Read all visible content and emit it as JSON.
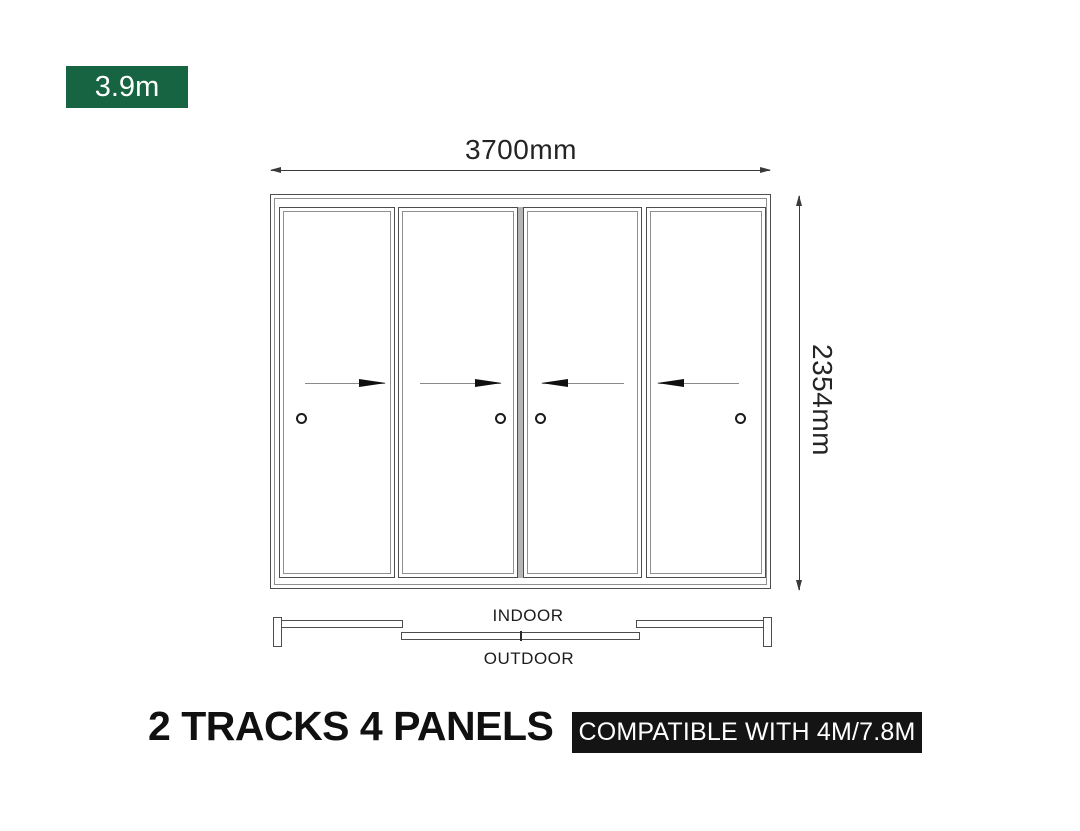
{
  "size_badge": {
    "label": "3.9m",
    "bg_color": "#166442",
    "text_color": "#ffffff"
  },
  "dimensions": {
    "width": {
      "label": "3700mm"
    },
    "height": {
      "label": "2354mm"
    }
  },
  "door_diagram": {
    "type": "sliding-door-elevation",
    "panel_count": 4,
    "track_count": 2,
    "panels": [
      {
        "id": 1,
        "slide_direction": "right",
        "handle_position": "left"
      },
      {
        "id": 2,
        "slide_direction": "right",
        "handle_position": "right"
      },
      {
        "id": 3,
        "slide_direction": "left",
        "handle_position": "left"
      },
      {
        "id": 4,
        "slide_direction": "left",
        "handle_position": "right"
      }
    ]
  },
  "track_plan": {
    "indoor_label": "INDOOR",
    "outdoor_label": "OUTDOOR"
  },
  "footer": {
    "title": "2 TRACKS 4 PANELS",
    "compatibility_badge": {
      "label": "COMPATIBLE WITH 4M/7.8M",
      "bg_color": "#141414",
      "text_color": "#ffffff"
    }
  },
  "colors": {
    "background": "#ffffff",
    "line_dark": "#4d4d4d",
    "line_light": "#8f8f8f",
    "dimension_text": "#242424",
    "meeting_stile_gray": "#b5b5b5"
  }
}
